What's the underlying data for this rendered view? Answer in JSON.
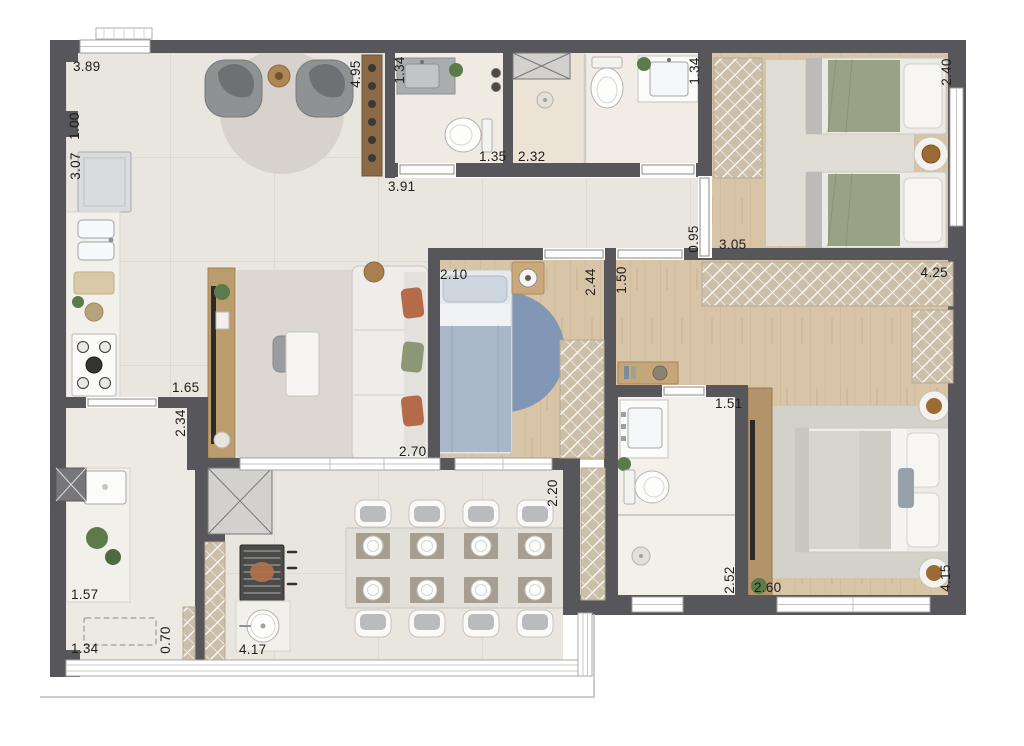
{
  "plan": {
    "type": "apartment-floor-plan",
    "unit": "m",
    "colors": {
      "wall": "#57565a",
      "floor_tile": "#e9e6e0",
      "wood_floor": "#d7c4a6",
      "marble": "#f3f0ea",
      "closet_hatch": "#cbbfa9",
      "rug_gray": "#d7d3cc",
      "rug_blue": "#8296b6",
      "plant_green": "#5d7b4a",
      "terracotta": "#b56a49",
      "sage_green": "#99a284",
      "label_text": "#1f1e1c",
      "glass_white": "#ffffff"
    },
    "dimensions": [
      {
        "id": "living-window-width",
        "value": "3.89",
        "orientation": "horizontal"
      },
      {
        "id": "left-wall-segment",
        "value": "1.00",
        "orientation": "vertical"
      },
      {
        "id": "kitchen-left-length",
        "value": "3.07",
        "orientation": "vertical"
      },
      {
        "id": "living-depth",
        "value": "4.95",
        "orientation": "vertical"
      },
      {
        "id": "lavabo-width",
        "value": "1.34",
        "orientation": "vertical"
      },
      {
        "id": "lavabo-door",
        "value": "1.35",
        "orientation": "horizontal"
      },
      {
        "id": "shower-area-width",
        "value": "2.32",
        "orientation": "horizontal"
      },
      {
        "id": "hall-length",
        "value": "3.91",
        "orientation": "horizontal"
      },
      {
        "id": "social-bath-width",
        "value": "1.34",
        "orientation": "vertical"
      },
      {
        "id": "twin-bedroom-depth",
        "value": "2.40",
        "orientation": "vertical"
      },
      {
        "id": "twin-door-opening",
        "value": "0.95",
        "orientation": "vertical"
      },
      {
        "id": "twin-bedroom-width",
        "value": "3.05",
        "orientation": "horizontal"
      },
      {
        "id": "bedroom2-width",
        "value": "2.10",
        "orientation": "horizontal"
      },
      {
        "id": "bedroom2-wall",
        "value": "2.44",
        "orientation": "vertical"
      },
      {
        "id": "suite-hall-width",
        "value": "1.50",
        "orientation": "vertical"
      },
      {
        "id": "suite-closet-width",
        "value": "4.25",
        "orientation": "horizontal"
      },
      {
        "id": "kitchen-opening",
        "value": "1.65",
        "orientation": "horizontal"
      },
      {
        "id": "kitchen-passage",
        "value": "2.34",
        "orientation": "vertical"
      },
      {
        "id": "bedroom2-depth",
        "value": "2.70",
        "orientation": "horizontal"
      },
      {
        "id": "suite-bath-width",
        "value": "1.51",
        "orientation": "horizontal"
      },
      {
        "id": "terrace-depth",
        "value": "2.20",
        "orientation": "vertical"
      },
      {
        "id": "suite-bath-depth",
        "value": "2.52",
        "orientation": "vertical"
      },
      {
        "id": "suite-entry-width",
        "value": "2.60",
        "orientation": "horizontal"
      },
      {
        "id": "suite-depth",
        "value": "4.15",
        "orientation": "vertical"
      },
      {
        "id": "laundry-width",
        "value": "1.57",
        "orientation": "horizontal"
      },
      {
        "id": "laundry-bench-width",
        "value": "1.34",
        "orientation": "horizontal"
      },
      {
        "id": "laundry-bench-depth",
        "value": "0.70",
        "orientation": "vertical"
      },
      {
        "id": "terrace-width",
        "value": "4.17",
        "orientation": "horizontal"
      }
    ]
  }
}
